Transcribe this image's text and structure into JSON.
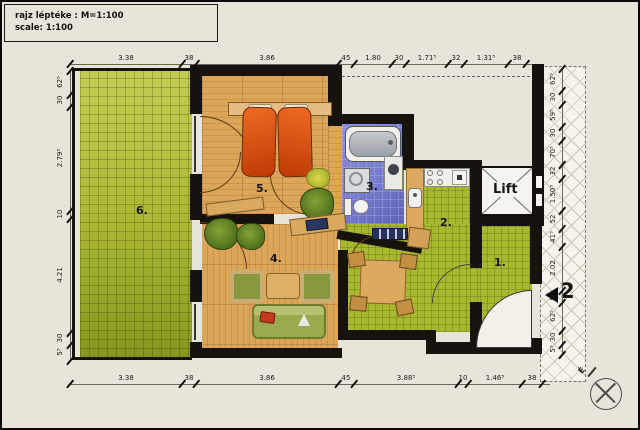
{
  "title_block": {
    "line1": "rajz léptéke : M=1:100",
    "line2": "scale: 1:100"
  },
  "rooms": {
    "r1": "1.",
    "r2": "2.",
    "r3": "3.",
    "r4": "4.",
    "r5": "5.",
    "r6": "6."
  },
  "lift": {
    "label": "Lift"
  },
  "entrance": {
    "number": "2"
  },
  "compass": {
    "label": "É"
  },
  "dimensions": {
    "top": [
      "3.38",
      "38",
      "3.86",
      "45",
      "1.80",
      "30",
      "1.71⁵",
      "32",
      "1.31⁵",
      "38"
    ],
    "bottom": [
      "3.38",
      "38",
      "3.86",
      "45",
      "3.88⁵",
      "10",
      "1.46⁵",
      "38"
    ],
    "left": [
      "62⁵",
      "30",
      "2.79⁵",
      "10",
      "4.21",
      "30",
      "5⁵"
    ],
    "right": [
      "62⁵",
      "30",
      "59⁵",
      "30",
      "70⁵",
      "32",
      "1.50⁵",
      "52",
      "41⁵",
      "2.02",
      "50",
      "62⁵",
      "30",
      "5⁵"
    ]
  },
  "colors": {
    "wall": "#17120d",
    "wood_floor": "#d49a4e",
    "green_tile": "#a9b92f",
    "balcony_tile": "#aebc33",
    "purple_tile": "#7b80cf",
    "bed_orange": "#dd4f12",
    "background": "#e9e4da"
  },
  "icons": {
    "compass": "compass-icon",
    "entrance_arrow": "arrow-left-icon"
  }
}
